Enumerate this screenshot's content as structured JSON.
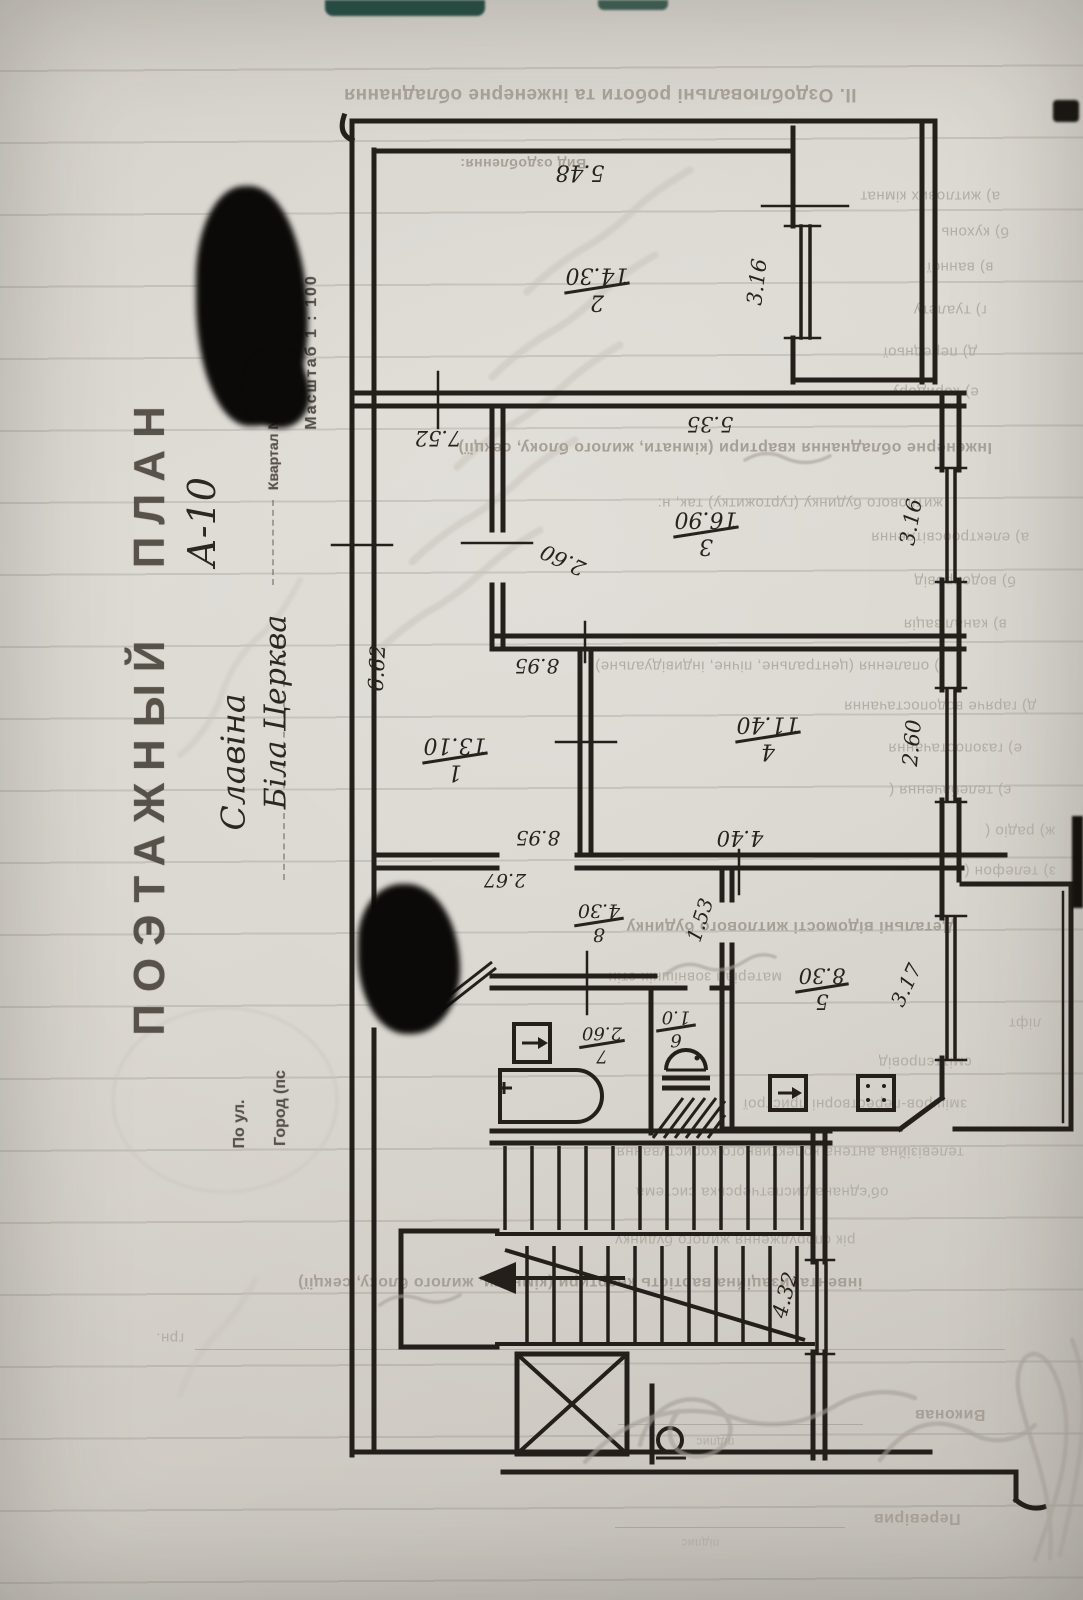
{
  "stamps": {
    "title": "ПОЭТАЖНЫЙ ПЛАН",
    "scale": "Масштаб 1 : 100",
    "block": "Квартал №",
    "street": "По ул.",
    "city_label": "Город (пс"
  },
  "handwriting": {
    "series": "А-10",
    "surname": "Славіна",
    "city": "Біла Церква"
  },
  "form": {
    "header": "ІІ. Оздоблювальні роботи та інженерне обладнання",
    "finish_title": "Вид оздоблення:",
    "finish_items": [
      "а) житлових кімнат",
      "б) кухонь",
      "в) ванної",
      "г) туалету",
      "д) передньої",
      "е) коридору"
    ],
    "eng_line1": "Інженерне обладнання квартири (кімнати, жилого блоку, секції)",
    "eng_line2": "житлового будинку (гуртожитку) так, н:",
    "eng_items": [
      "а) електроосвітлення",
      "б) водопровід",
      "в) каналізація",
      "г) опалення (центральне, пічне, індивідуальне)",
      "д) гаряче водопостачання",
      "е) газопостачання",
      "є) телебачення (",
      "ж) радіо (",
      "з) телефон ("
    ],
    "details_title": "Детальні відомості житлового будинку",
    "details_items": [
      "матеріал зовнішніх стін",
      "ліфт",
      "сміттєпровід",
      "змішров-перестворні пристрої",
      "телевізійна антена колективного користування",
      "об'єднана диспетчерська система",
      "рік спорудження жилого будинку"
    ],
    "cost_line": "інвентаризаційна вартість квартири (кімнати, жилого блоку, секції)",
    "currency": "грн.",
    "made_by": "Виконав",
    "checked_by": "Перевірив",
    "signature": "підпис"
  },
  "plan": {
    "rooms": [
      {
        "n": "1",
        "a": "13.10"
      },
      {
        "n": "2",
        "a": "14.30"
      },
      {
        "n": "3",
        "a": "16.90"
      },
      {
        "n": "4",
        "a": "11.40"
      },
      {
        "n": "5",
        "a": "8.30"
      },
      {
        "n": "6",
        "a": "1.0"
      },
      {
        "n": "7",
        "a": "2.60"
      },
      {
        "n": "8",
        "a": "4.30"
      }
    ],
    "dims": {
      "d548": "5.48",
      "d316a": "3.16",
      "d752": "7.52",
      "d535": "5.35",
      "d260diag": "2.60",
      "d316b": "3.16",
      "d662": "6.62",
      "d895a": "8.95",
      "d895b": "8.95",
      "d440": "4.40",
      "d260b": "2.60",
      "d267": "2.67",
      "d153": "1.53",
      "d317": "3.17",
      "d432": "4.32"
    }
  }
}
